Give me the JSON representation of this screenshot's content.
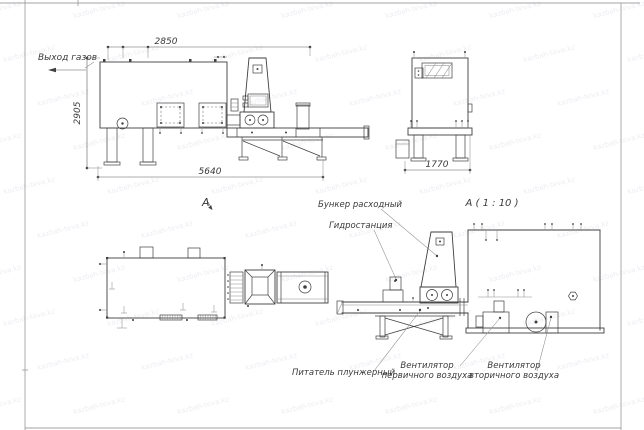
{
  "drawing": {
    "labels": {
      "gas_outlet": "Выход газов",
      "view_a": "А",
      "section_a": "А ( 1 : 10 )",
      "bunker": "Бункер расходный",
      "hydro": "Гидростанция",
      "feeder": "Питатель плунжерный",
      "fan_primary_line1": "Вентилятор",
      "fan_primary_line2": "первичного воздуха",
      "fan_secondary_line1": "Вентилятор",
      "fan_secondary_line2": "вторичного воздуха"
    },
    "dimensions": {
      "width_top": "2850",
      "height_left": "2905",
      "length_total": "5640",
      "depth_side": "1770"
    },
    "colors": {
      "line": "#3f3f3f",
      "thin_line": "#8e8e8e",
      "frame": "#a3a3a3",
      "watermark": "#7e89a3",
      "background": "#ffffff",
      "text": "#3a3a3a"
    },
    "watermark": {
      "text": "kazbah-teva.kz"
    }
  }
}
